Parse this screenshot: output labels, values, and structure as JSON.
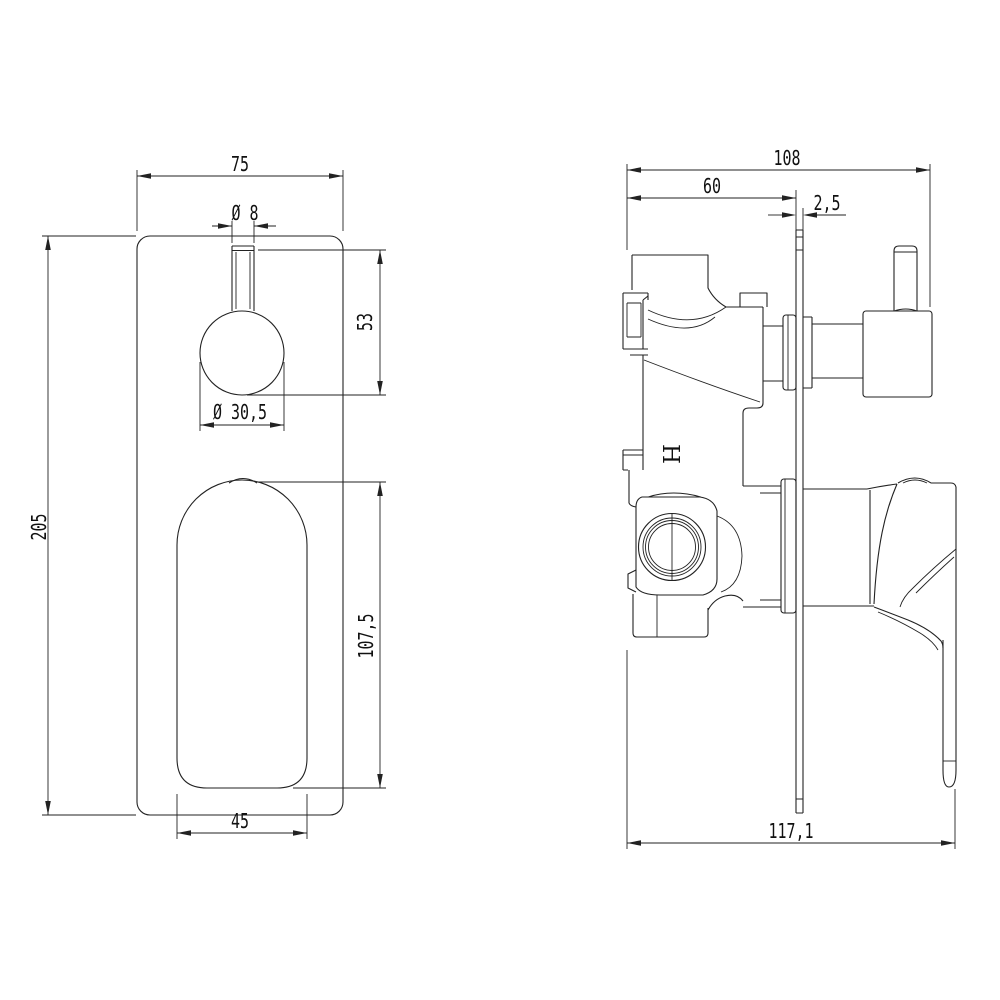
{
  "front_view": {
    "plate_width": "75",
    "stem_diameter": "Ø 8",
    "knob_drop": "53",
    "knob_diameter": "Ø 30,5",
    "plate_height": "205",
    "paddle_height": "107,5",
    "paddle_width": "45"
  },
  "side_view": {
    "depth_to_knob": "108",
    "body_depth": "60",
    "plate_thickness": "2,5",
    "total_depth": "117,1",
    "hot_marking": "H"
  },
  "style": {
    "line_color": "#222222",
    "background": "#ffffff"
  }
}
